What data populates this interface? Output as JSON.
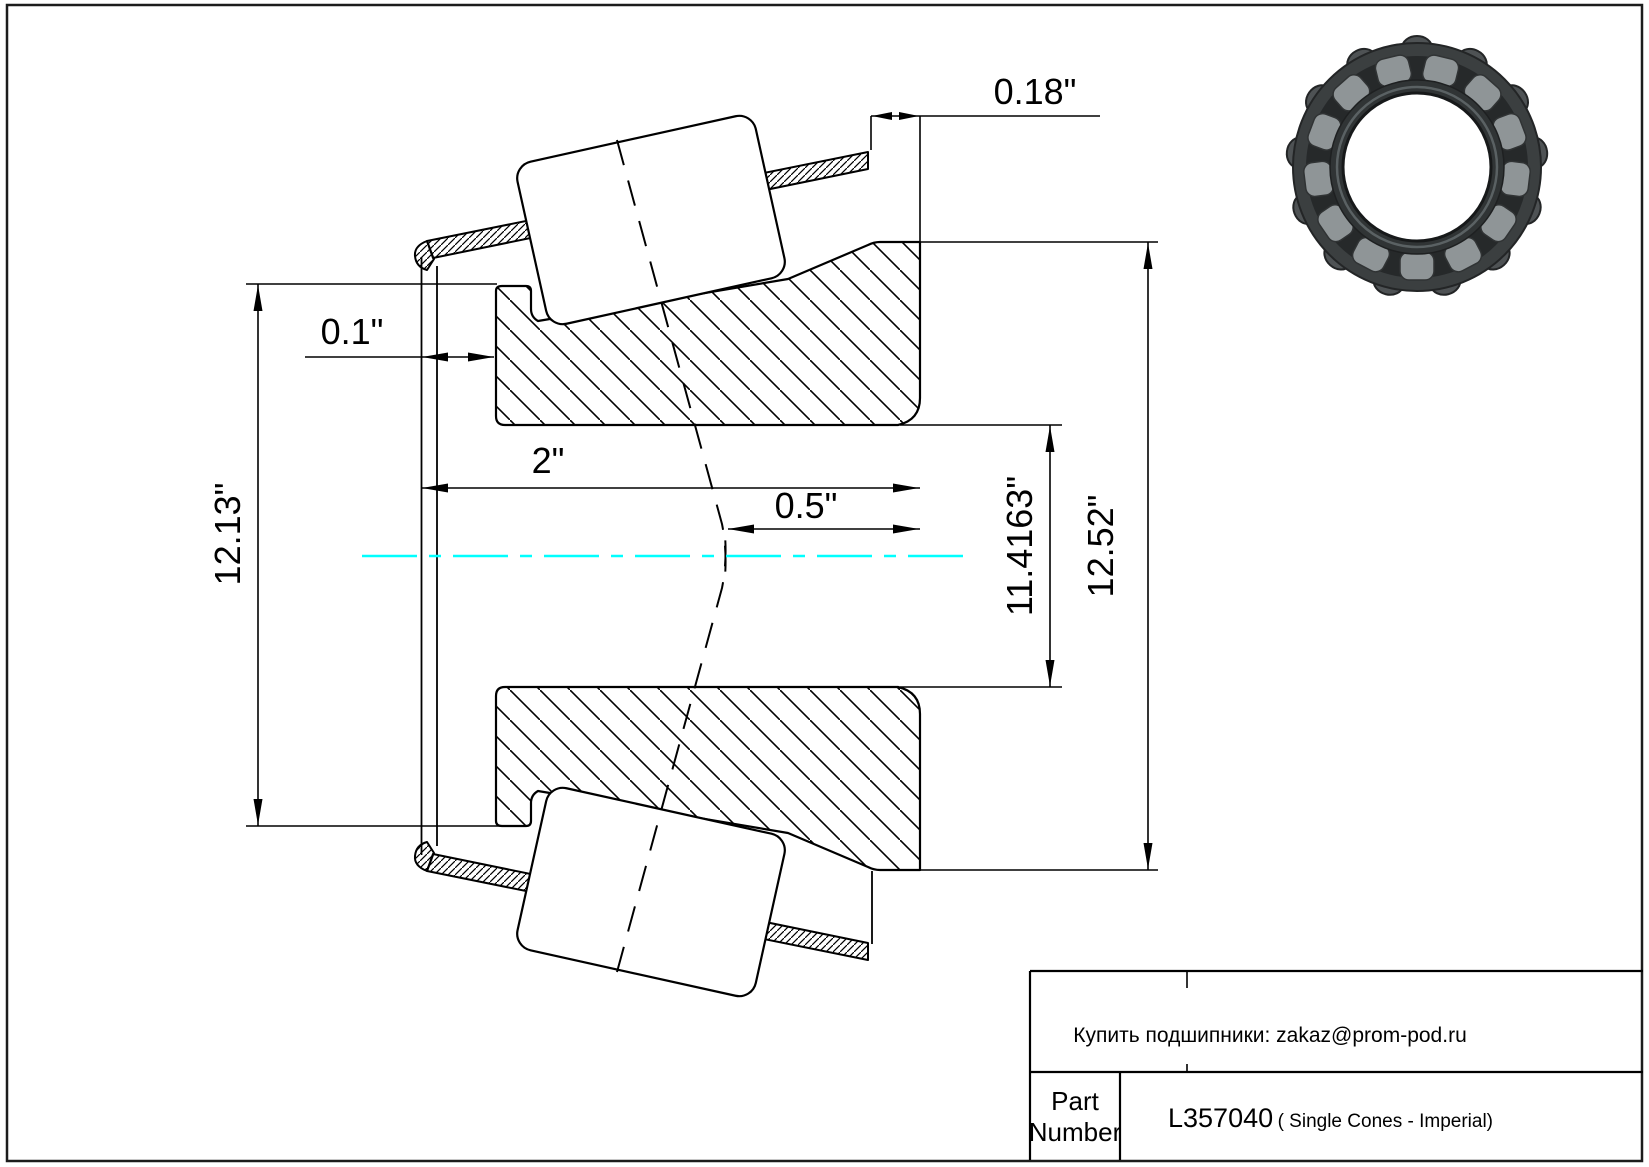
{
  "drawing": {
    "type": "bearing-single-cone-cross-section",
    "dims": {
      "width_018": "0.18\"",
      "standoff_01": "0.1\"",
      "bore_ref_2": "2\"",
      "offset_05": "0.5\"",
      "front_od_1213": "12.13\"",
      "bore_dia_114163": "11.4163\"",
      "back_od_1252": "12.52\""
    },
    "colors": {
      "line": "#000000",
      "centerline": "#00ffff",
      "background": "#ffffff"
    }
  },
  "bearing_photo": {
    "outer_ring": "#3b3f40",
    "cage": "#26292a",
    "roller": "#8f9597",
    "inner_ring": "#303435",
    "bore": "#ffffff"
  },
  "title_block": {
    "contact": "Купить подшипники: zakaz@prom-pod.ru",
    "part_label_1": "Part",
    "part_label_2": "Number",
    "part_number": "L357040",
    "part_suffix": " ( Single Cones - Imperial)"
  }
}
